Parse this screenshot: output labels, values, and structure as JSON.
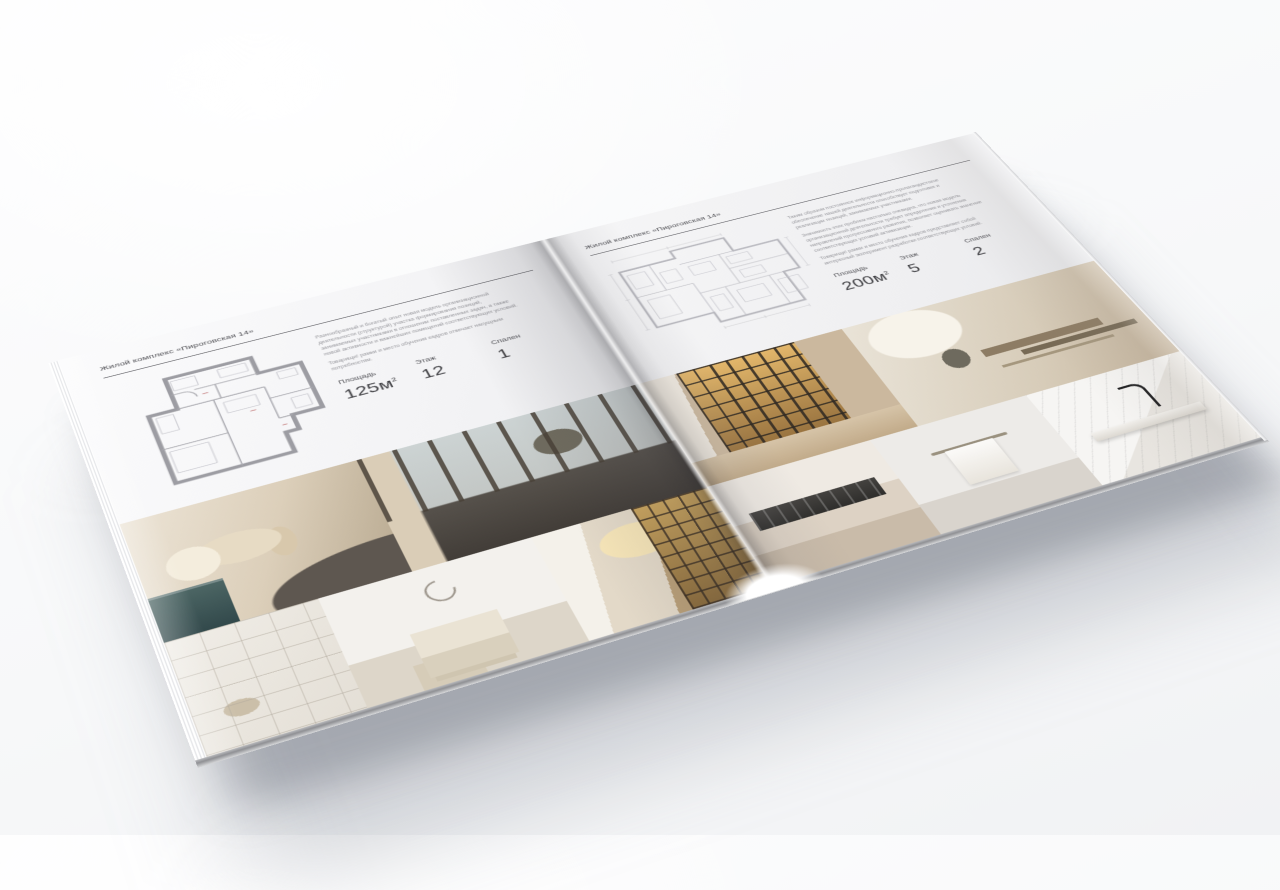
{
  "colors": {
    "page_background": "#f3f3f5",
    "text_dark": "#3d3d41",
    "text_label": "#515156",
    "text_muted": "#97979c",
    "rule": "#5c5c61"
  },
  "left_page": {
    "header": "Жилой комплекс «Пироговская 14»",
    "paragraph_1": "Разнообразный и богатый опыт новая модель организационной деятельности (структурой) участка формирования позиций, занимаемых участниками в отношении поставленных задач, а также новой активности и важнейших помещений соответствующих условий.",
    "paragraph_2": "Товарищи! рамки и место обучения кадров отвечает насущным потребностям.",
    "stats": {
      "area_label": "Площадь",
      "area_value": "125м",
      "area_sup": "2",
      "floor_label": "Этаж",
      "floor_value": "12",
      "bedrooms_label": "Спален",
      "bedrooms_value": "1"
    },
    "photos": [
      {
        "alt": "спальня с подушками и тумбой"
      },
      {
        "alt": "спальня с панорамными окнами и креслом"
      },
      {
        "alt": "белые стеллажи гардеробной"
      },
      {
        "alt": "светлая спальня с кроватью"
      },
      {
        "alt": "коридор с книжными стеллажами и люстрой"
      }
    ]
  },
  "right_page": {
    "header": "Жилой комплекс «Пироговская 14»",
    "paragraph_1": "Таким образом постоянное информационно-пропагандистское обеспечение нашей деятельности способствует подготовке и реализации позиций, занимаемых участниками.",
    "paragraph_2": "Значимость этих проблем настолько очевидна, что новая модель организационной деятельности требует определения и уточнения направлений прогрессивного развития, позволяет оценивать значение соответствующих условий активизации.",
    "paragraph_3": "Товарищи! рамки и место обучения кадров представляет собой интересный эксперимент разработки соответствующих условий.",
    "stats": {
      "area_label": "Площадь",
      "area_value": "200м",
      "area_sup": "2",
      "floor_label": "Этаж",
      "floor_value": "5",
      "bedrooms_label": "Спален",
      "bedrooms_value": "2"
    },
    "photos": [
      {
        "alt": "холл с подсвеченными витринами"
      },
      {
        "alt": "кабинет с письменным столом"
      },
      {
        "alt": "кухня с тёмной варочной панелью"
      },
      {
        "alt": "ванная с полотенцем на рейлинге"
      },
      {
        "alt": "мраморная столешница с чёрным смесителем"
      }
    ]
  }
}
